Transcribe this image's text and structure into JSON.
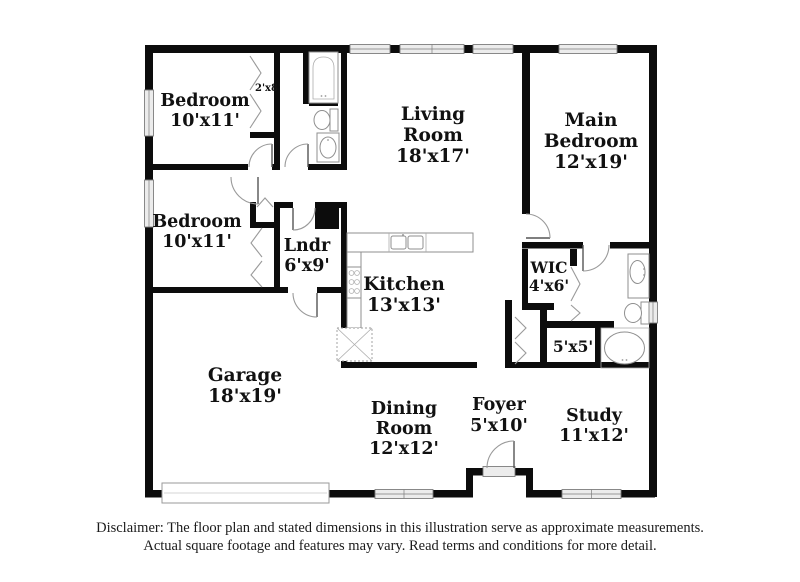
{
  "rooms": {
    "bedroom_top": {
      "label": "Bedroom",
      "dims": "10'x11'"
    },
    "closet_top": {
      "dims": "2'x8'"
    },
    "living": {
      "label1": "Living",
      "label2": "Room",
      "dims": "18'x17'"
    },
    "main_bedroom": {
      "label1": "Main",
      "label2": "Bedroom",
      "dims": "12'x19'"
    },
    "bedroom_mid": {
      "label": "Bedroom",
      "dims": "10'x11'"
    },
    "laundry": {
      "label": "Lndr",
      "dims": "6'x9'"
    },
    "kitchen": {
      "label": "Kitchen",
      "dims": "13'x13'"
    },
    "wic": {
      "label": "WIC",
      "dims": "4'x6'"
    },
    "closet_5x5": {
      "dims": "5'x5'"
    },
    "garage": {
      "label": "Garage",
      "dims": "18'x19'"
    },
    "dining": {
      "label1": "Dining",
      "label2": "Room",
      "dims": "12'x12'"
    },
    "foyer": {
      "label": "Foyer",
      "dims": "5'x10'"
    },
    "study": {
      "label": "Study",
      "dims": "11'x12'"
    }
  },
  "fixtures": [
    "bathtub-icon",
    "toilet-icon",
    "sink-icon",
    "stove-icon",
    "kitchen-sink-icon",
    "water-heater-icon",
    "cabinet-icon",
    "garage-door-icon",
    "entry-door-icon"
  ],
  "colors": {
    "wall": "#0c0c0c",
    "window_fill": "#ececec",
    "symbol_stroke": "#9a9a9a",
    "background": "#ffffff"
  },
  "disclaimer": {
    "line1": "Disclaimer: The floor plan and stated dimensions in this illustration serve as approximate measurements.",
    "line2": "Actual square footage and features may vary. Read terms and conditions for more detail."
  }
}
